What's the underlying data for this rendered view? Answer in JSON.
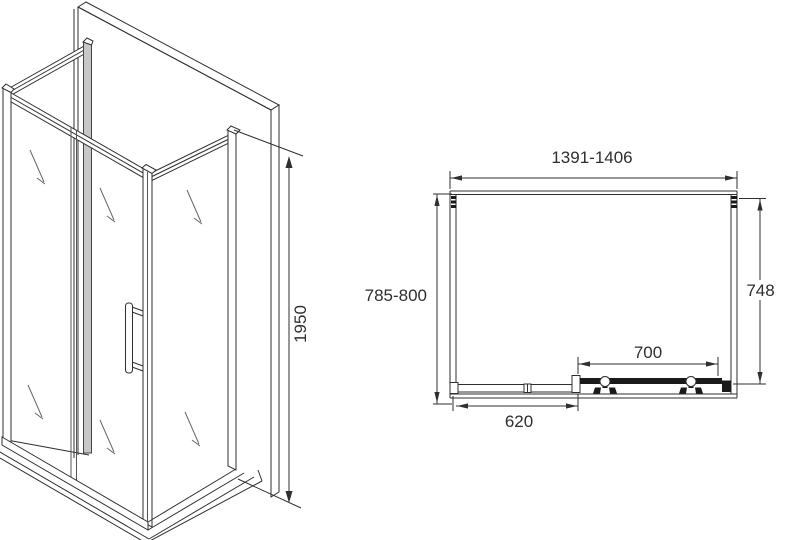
{
  "document": {
    "type": "technical-drawing",
    "subject": "corner shower enclosure with sliding door",
    "background": "#ffffff",
    "line_color": "#2f2f2f",
    "frame_gray": "#c7c7c7",
    "door_bar_color": "#1a1a1a"
  },
  "iso_view": {
    "name": "isometric view",
    "height_dimension": "1950"
  },
  "plan_view": {
    "name": "plan view",
    "overall_width": "1391-1406",
    "depth_left": "785-800",
    "depth_right": "748",
    "door_width": "700",
    "fixed_panel_width": "620"
  }
}
